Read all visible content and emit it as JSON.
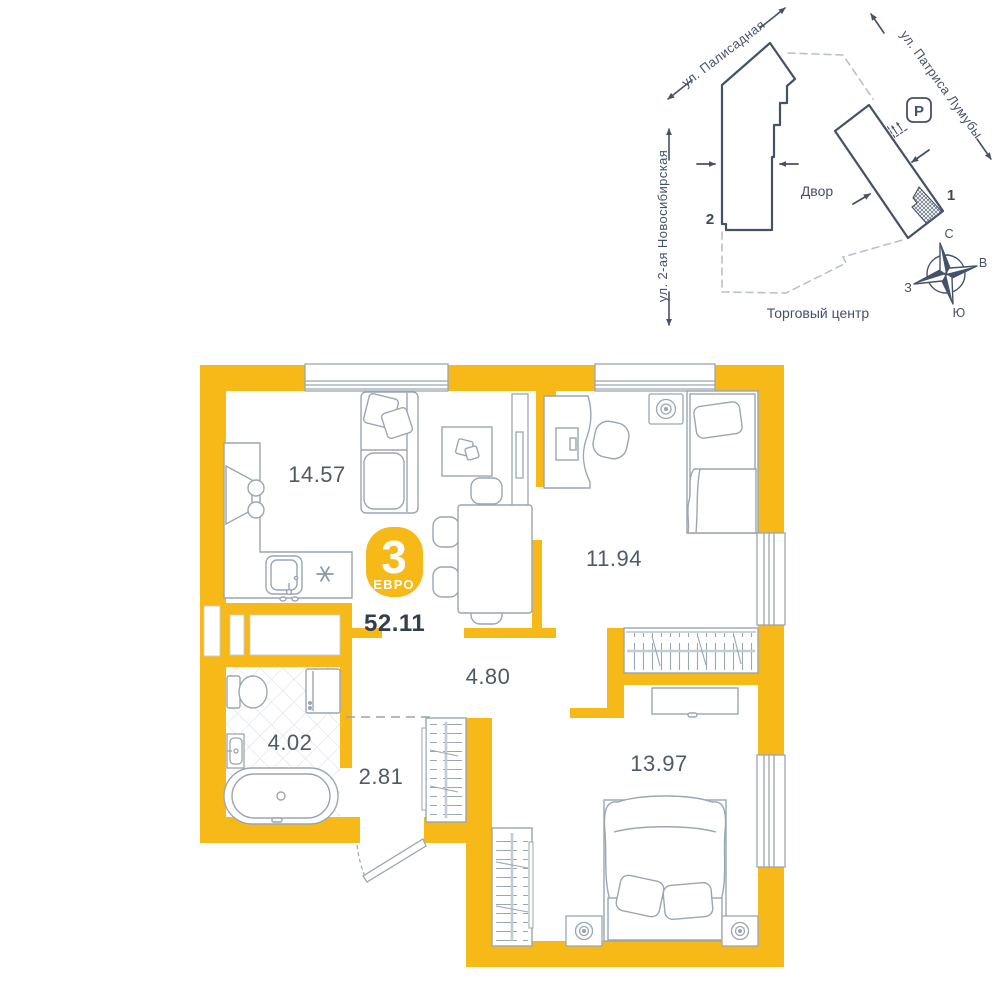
{
  "floor_plan": {
    "badge": {
      "rooms": "3",
      "type": "ЕВРО",
      "total_area": "52.11"
    },
    "rooms": [
      {
        "id": "kitchen-living",
        "area": "14.57"
      },
      {
        "id": "bedroom-1",
        "area": "11.94"
      },
      {
        "id": "corridor",
        "area": "4.80"
      },
      {
        "id": "bathroom",
        "area": "4.02"
      },
      {
        "id": "hall",
        "area": "2.81"
      },
      {
        "id": "bedroom-2",
        "area": "13.97"
      }
    ],
    "stove_symbol": "✳"
  },
  "site_plan": {
    "streets": {
      "top": "ул. Палисадная",
      "right": "ул. Патриса Лумубы",
      "left": "ул. 2-ая Новосибирская"
    },
    "labels": {
      "courtyard": "Двор",
      "mall": "Торговый центр",
      "parking": "P",
      "building_1": "1",
      "building_2": "2"
    },
    "compass": {
      "n": "С",
      "e": "В",
      "s": "Ю",
      "w": "З"
    }
  },
  "colors": {
    "accent_yellow": "#F7B917",
    "furniture_gray": "#9AA6B2",
    "ink": "#44516B"
  }
}
